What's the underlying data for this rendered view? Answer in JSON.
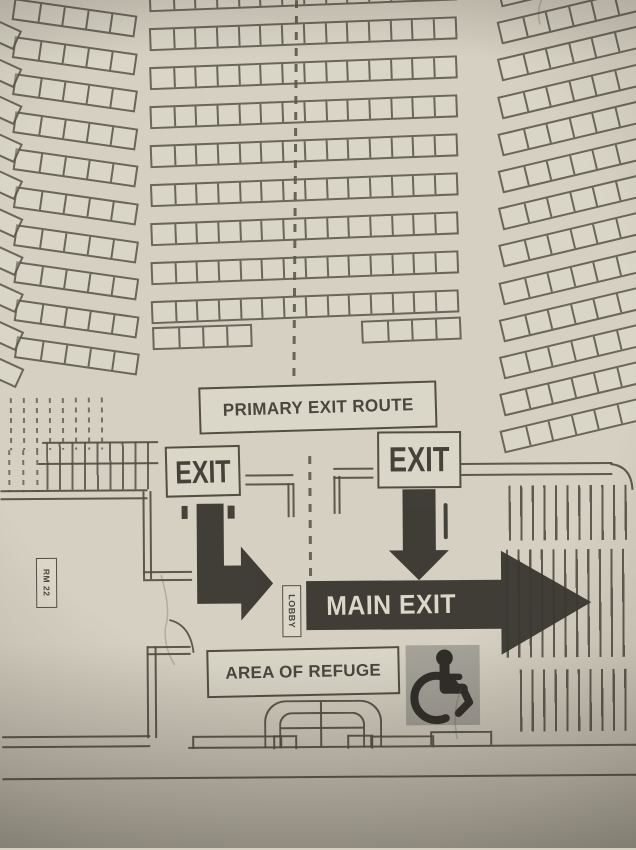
{
  "labels": {
    "primary_exit_route": "PRIMARY EXIT ROUTE",
    "exit_left": "EXIT",
    "exit_right": "EXIT",
    "main_exit": "MAIN EXIT",
    "area_of_refuge": "AREA OF REFUGE",
    "lobby": "LOBBY",
    "room": "RM 22"
  },
  "icons": {
    "accessibility": "wheelchair-icon"
  },
  "colors": {
    "paper": "#d7d2c4",
    "ink": "#55524a",
    "arrow_dark": "#3a3832",
    "accessible_tile": "#a5a29a",
    "arrow_text": "#dcd7c9"
  },
  "seating": {
    "center": {
      "rows": 9,
      "seats_per_row": 14,
      "x": 152,
      "y_start": -12,
      "row_gap": 39,
      "seat_w": 21.7,
      "seat_h": 23,
      "rotate": -1.8
    },
    "left": {
      "rows": 10,
      "seats_per_row": 5,
      "x": 16,
      "y_start": -4,
      "row_gap": 37.6,
      "seat_w": 24,
      "seat_h": 22,
      "rotate": 8.5
    },
    "right": {
      "rows": 13,
      "seats_per_row": 7,
      "x": 502,
      "y_start": -14,
      "row_gap": 37.2,
      "seat_w": 23.5,
      "seat_h": 23,
      "rotate": -13
    },
    "extra_segments": [
      {
        "x": 153,
        "y": 326,
        "seats": 4,
        "seat_w": 24,
        "seat_h": 23,
        "rotate": -1.5
      },
      {
        "x": 362,
        "y": 321,
        "seats": 4,
        "seat_w": 24,
        "seat_h": 23,
        "rotate": -2
      }
    ],
    "left_edge": {
      "boxes": 10,
      "x": -14,
      "y_start": 12,
      "gap": 37.6,
      "w": 34,
      "h": 21,
      "rotate": 25
    }
  }
}
